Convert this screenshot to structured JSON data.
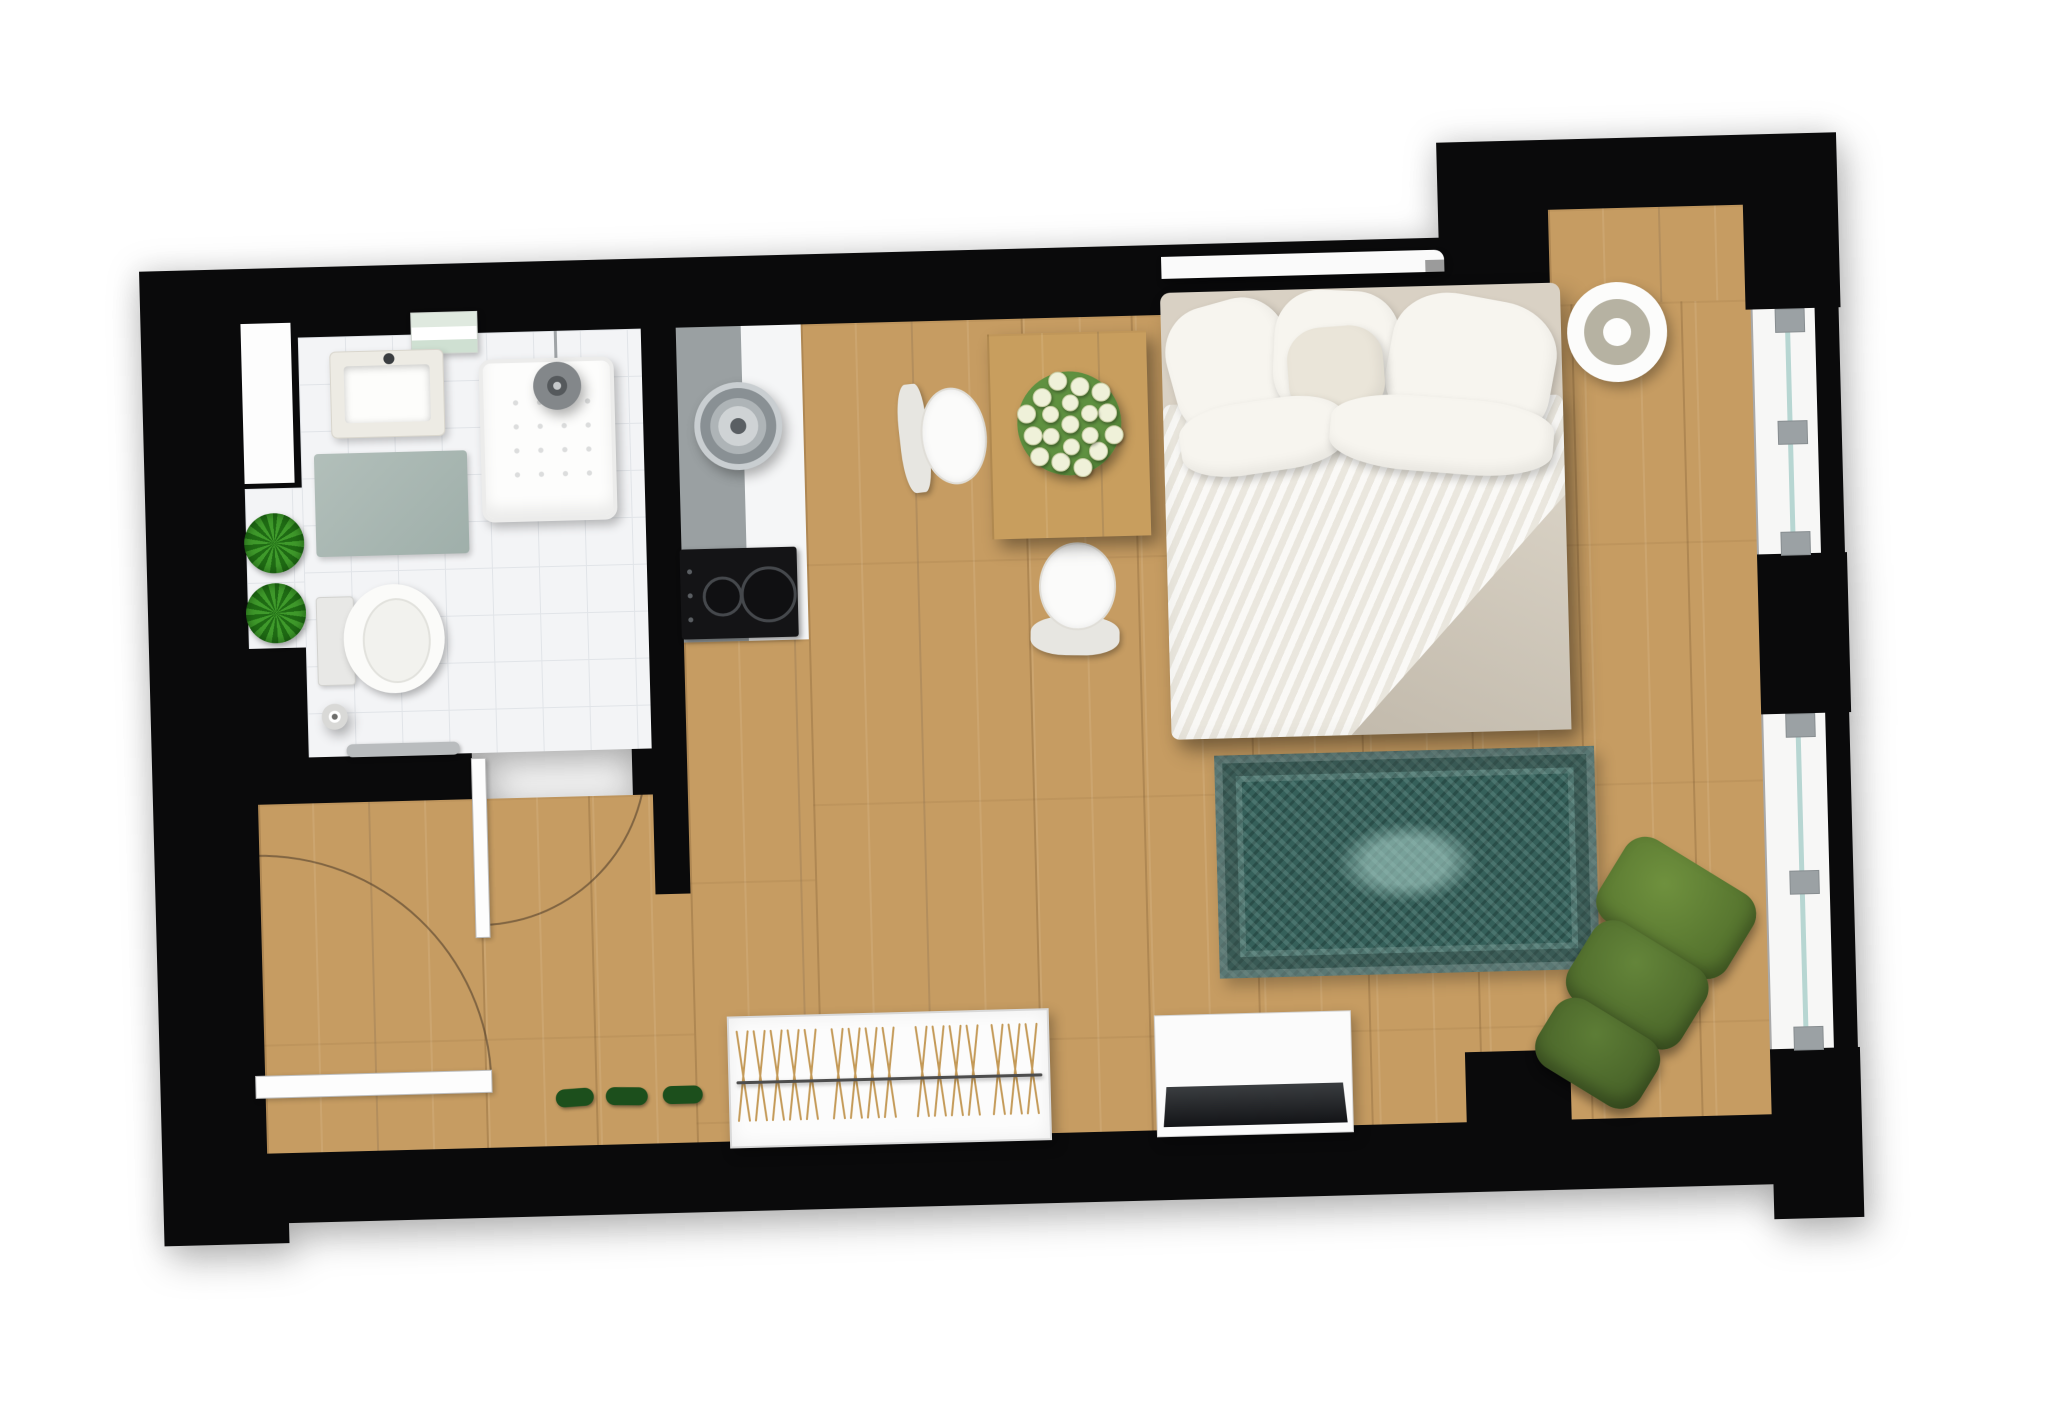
{
  "meta": {
    "description": "Top-down rendered floor plan of a studio apartment with bathroom, kitchenette, dining area, double bed, rug, armchair, wardrobe and TV console",
    "visible_text": []
  },
  "palette": {
    "wall": "#0a0a0b",
    "wood_floor": "#c69c62",
    "table_wood": "#c89e5e",
    "bathroom_tile": "#f3f4f6",
    "tile_grid": "#e1e4e8",
    "counter_gray": "#9aa0a2",
    "counter_white": "#f5f6f7",
    "rug_teal": "#35605a",
    "rug_light": "#a5cdc5",
    "bedding_white": "#f3f1eb",
    "bedding_beige": "#d9d1c4",
    "armchair_green": "#5d7d36",
    "plant_green": "#3f9a2b",
    "shoe_green": "#1c4f1c",
    "glass": "#b7d6d2",
    "door_swing": "rgba(74,58,40,0.55)"
  },
  "plan": {
    "origin_left": 150,
    "origin_top": 170,
    "width": 1710,
    "height": 1100,
    "rotation_deg": -1.5
  },
  "items": [
    {
      "n": "floor-main",
      "t": "wood",
      "x": 660,
      "y": 170,
      "w": 950,
      "h": 815
    },
    {
      "n": "floor-under-kitchen",
      "t": "wood",
      "x": 535,
      "y": 485,
      "w": 125,
      "h": 500
    },
    {
      "n": "floor-entry",
      "t": "wood",
      "x": 105,
      "y": 636,
      "w": 430,
      "h": 349
    },
    {
      "n": "alcove-floor",
      "t": "wood",
      "x": 1410,
      "y": 75,
      "w": 195,
      "h": 95
    },
    {
      "n": "bathroom-floor",
      "t": "tile",
      "x": 157,
      "y": 170,
      "w": 343,
      "h": 420
    },
    {
      "n": "kitchen-counter-gray",
      "t": "rect",
      "x": 535,
      "y": 170,
      "w": 65,
      "h": 315,
      "c": "#9aa0a2"
    },
    {
      "n": "kitchen-counter-white",
      "t": "rect",
      "x": 600,
      "y": 170,
      "w": 60,
      "h": 315,
      "c": "#f5f6f7"
    },
    {
      "n": "rug",
      "t": "rug",
      "x": 1062,
      "y": 612,
      "w": 380,
      "h": 223
    },
    {
      "n": "entry-door-swing",
      "t": "arc",
      "x": 100,
      "y": 686,
      "w": 232,
      "h": 232,
      "corner": "tr"
    },
    {
      "n": "bathroom-door-swing",
      "t": "arc",
      "x": 327,
      "y": 595,
      "w": 168,
      "h": 168,
      "corner": "br"
    },
    {
      "n": "wall-top",
      "t": "wall",
      "x": 0,
      "y": 100,
      "w": 1300,
      "h": 70
    },
    {
      "n": "wall-topright-pier",
      "t": "wall",
      "x": 1300,
      "y": 5,
      "w": 110,
      "h": 165
    },
    {
      "n": "wall-topright-top",
      "t": "wall",
      "x": 1410,
      "y": 5,
      "w": 290,
      "h": 70
    },
    {
      "n": "wall-topright-right",
      "t": "wall",
      "x": 1605,
      "y": 75,
      "w": 95,
      "h": 105
    },
    {
      "n": "wall-right-mid",
      "t": "wall",
      "x": 1610,
      "y": 425,
      "w": 90,
      "h": 160
    },
    {
      "n": "wall-right-lower",
      "t": "wall",
      "x": 1610,
      "y": 920,
      "w": 90,
      "h": 170
    },
    {
      "n": "wall-bottom",
      "t": "wall",
      "x": 0,
      "y": 985,
      "w": 1700,
      "h": 70
    },
    {
      "n": "wall-bottom-pier",
      "t": "wall",
      "x": 1305,
      "y": 915,
      "w": 105,
      "h": 70
    },
    {
      "n": "wall-bottomleft-step",
      "t": "wall",
      "x": 0,
      "y": 985,
      "w": 125,
      "h": 90
    },
    {
      "n": "wall-left-upper",
      "t": "wall",
      "x": 0,
      "y": 100,
      "w": 157,
      "h": 380
    },
    {
      "n": "wall-left-mid",
      "t": "wall",
      "x": 0,
      "y": 480,
      "w": 157,
      "h": 110
    },
    {
      "n": "wall-left-lower",
      "t": "wall",
      "x": 0,
      "y": 590,
      "w": 105,
      "h": 465
    },
    {
      "n": "wall-bath-kitchen",
      "t": "wall",
      "x": 500,
      "y": 100,
      "w": 35,
      "h": 636
    },
    {
      "n": "wall-bath-bottom-left",
      "t": "wall",
      "x": 105,
      "y": 590,
      "w": 215,
      "h": 46
    },
    {
      "n": "wall-bath-bottom-right",
      "t": "wall",
      "x": 480,
      "y": 590,
      "w": 20,
      "h": 46
    },
    {
      "n": "left-wall-window",
      "t": "rect",
      "x": 100,
      "y": 155,
      "w": 50,
      "h": 160,
      "c": "#fdfdfd",
      "cls": "nich"
    },
    {
      "n": "plant-shelf",
      "t": "tile",
      "x": 100,
      "y": 320,
      "w": 57,
      "h": 160,
      "cls": "nich"
    },
    {
      "n": "plant-top",
      "t": "plant",
      "x": 98,
      "y": 345,
      "w": 60,
      "h": 60
    },
    {
      "n": "plant-bottom",
      "t": "plant",
      "x": 98,
      "y": 415,
      "w": 60,
      "h": 60
    },
    {
      "n": "towel-shelf",
      "t": "towels",
      "x": 270,
      "y": 148,
      "w": 67,
      "h": 42
    },
    {
      "n": "bathroom-sink",
      "t": "sinkunit",
      "x": 188,
      "y": 185,
      "w": 114,
      "h": 87
    },
    {
      "n": "bath-mat",
      "t": "rect",
      "x": 170,
      "y": 287,
      "w": 153,
      "h": 103,
      "cls": "mat"
    },
    {
      "n": "shower-tray",
      "t": "shower",
      "x": 337,
      "y": 197,
      "w": 135,
      "h": 163
    },
    {
      "n": "shower-cord",
      "t": "rect",
      "x": 413,
      "y": 165,
      "w": 3,
      "h": 45,
      "c": "#9fa3a6"
    },
    {
      "n": "shower-head",
      "t": "rings",
      "x": 391,
      "y": 201,
      "w": 48,
      "h": 48,
      "rings": [
        [
          24,
          "#83878a"
        ],
        [
          10,
          "#55595c"
        ],
        [
          4,
          "#c6c9cb"
        ]
      ]
    },
    {
      "n": "toilet",
      "t": "toilet",
      "x": 168,
      "y": 419,
      "w": 128,
      "h": 109
    },
    {
      "n": "toilet-paper-holder",
      "t": "rings",
      "x": 171,
      "y": 537,
      "w": 26,
      "h": 26,
      "rings": [
        [
          13,
          "#d9d9d7"
        ],
        [
          6,
          "#ffffff"
        ],
        [
          3,
          "#6d6d6b"
        ]
      ]
    },
    {
      "n": "towel-rail",
      "t": "rect",
      "x": 195,
      "y": 578,
      "w": 113,
      "h": 13,
      "c": "#b9bcbe",
      "cls": "rail"
    },
    {
      "n": "entry-door-leaf",
      "t": "rect",
      "x": 95,
      "y": 907,
      "w": 237,
      "h": 23,
      "cls": "leaf"
    },
    {
      "n": "bathroom-door-leaf",
      "t": "rect",
      "x": 319,
      "y": 595,
      "w": 15,
      "h": 180,
      "cls": "leaf"
    },
    {
      "n": "kitchen-sink",
      "t": "rings",
      "x": 551,
      "y": 226,
      "w": 88,
      "h": 88,
      "rings": [
        [
          44,
          "#c9ced1"
        ],
        [
          38,
          "#899094"
        ],
        [
          28,
          "#aeb4b7"
        ],
        [
          20,
          "#cfd3d5"
        ],
        [
          8,
          "#5a5f63"
        ]
      ]
    },
    {
      "n": "cooktop",
      "t": "cooktop",
      "x": 533,
      "y": 392,
      "w": 117,
      "h": 90
    },
    {
      "n": "dining-table",
      "t": "wood",
      "x": 846,
      "y": 185,
      "w": 159,
      "h": 205,
      "cls": "table"
    },
    {
      "n": "flower-bouquet",
      "t": "flowers",
      "x": 861,
      "y": 211,
      "w": 130,
      "h": 130
    },
    {
      "n": "dining-chair-left",
      "t": "chair",
      "x": 756,
      "y": 223,
      "w": 86,
      "h": 123,
      "dir": "left",
      "rot": -5
    },
    {
      "n": "dining-chair-bottom",
      "t": "chair",
      "x": 877,
      "y": 390,
      "w": 101,
      "h": 123,
      "dir": "down",
      "rot": 2
    },
    {
      "n": "wall-shelf",
      "t": "rect",
      "x": 1022,
      "y": 112,
      "w": 283,
      "h": 22,
      "c": "#fafafa",
      "cls": "shelf"
    },
    {
      "n": "shelf-bracket",
      "t": "rect",
      "x": 1286,
      "y": 122,
      "w": 19,
      "h": 12,
      "c": "#9b9b9b",
      "cls": "bracket"
    },
    {
      "n": "bed",
      "t": "rect",
      "x": 1020,
      "y": 148,
      "w": 400,
      "h": 447,
      "c": "#d9d1c4",
      "cls": "bed"
    },
    {
      "n": "duvet",
      "t": "rect",
      "x": 1020,
      "y": 260,
      "w": 400,
      "h": 335,
      "cls": "duvet"
    },
    {
      "n": "duvet-fold",
      "t": "fold",
      "x": 1200,
      "y": 360,
      "w": 220,
      "h": 235
    },
    {
      "n": "pillow-left",
      "t": "pillow",
      "x": 1028,
      "y": 158,
      "w": 124,
      "h": 134,
      "rot": -14
    },
    {
      "n": "pillow-center",
      "t": "pillow",
      "x": 1132,
      "y": 150,
      "w": 126,
      "h": 128,
      "rot": 4
    },
    {
      "n": "pillow-right",
      "t": "pillow",
      "x": 1246,
      "y": 160,
      "w": 166,
      "h": 140,
      "rot": 12
    },
    {
      "n": "pillow-small",
      "t": "pillow",
      "x": 1146,
      "y": 186,
      "w": 96,
      "h": 90,
      "rot": -3,
      "c": "#eae5d9"
    },
    {
      "n": "pillow-lower-left",
      "t": "pillow",
      "x": 1036,
      "y": 258,
      "w": 166,
      "h": 72,
      "rot": -7
    },
    {
      "n": "pillow-lower-right",
      "t": "pillow",
      "x": 1186,
      "y": 260,
      "w": 224,
      "h": 75,
      "rot": 6
    },
    {
      "n": "decor-bowl",
      "t": "rings",
      "x": 1426,
      "y": 149,
      "w": 100,
      "h": 100,
      "rings": [
        [
          50,
          "#fcfcfb"
        ],
        [
          33,
          "#b6b2a2"
        ],
        [
          14,
          "#fdfdfc"
        ]
      ]
    },
    {
      "n": "armchair",
      "t": "armchair",
      "x": 1375,
      "y": 710,
      "w": 200,
      "h": 260,
      "rot": 33
    },
    {
      "n": "wardrobe",
      "t": "wardrobe",
      "x": 568,
      "y": 860,
      "w": 322,
      "h": 132,
      "count": 16
    },
    {
      "n": "tv-console",
      "t": "rect",
      "x": 995,
      "y": 870,
      "w": 197,
      "h": 122,
      "c": "#fbfbfb",
      "cls": "console"
    },
    {
      "n": "tv",
      "t": "tv",
      "x": 1002,
      "y": 942,
      "w": 184,
      "h": 40
    },
    {
      "n": "shoe-1",
      "t": "rect",
      "x": 395,
      "y": 928,
      "w": 38,
      "h": 18,
      "c": "#1c4f1c",
      "cls": "shoe",
      "rot": -3
    },
    {
      "n": "shoe-2",
      "t": "rect",
      "x": 445,
      "y": 928,
      "w": 42,
      "h": 18,
      "c": "#1c4f1c",
      "cls": "shoe",
      "rot": 2
    },
    {
      "n": "shoe-3",
      "t": "rect",
      "x": 502,
      "y": 928,
      "w": 40,
      "h": 18,
      "c": "#1c4f1c",
      "cls": "shoe"
    },
    {
      "n": "window-top",
      "t": "window",
      "x": 1612,
      "y": 180,
      "w": 86,
      "h": 245,
      "tabs": [
        0,
        112,
        223
      ]
    },
    {
      "n": "window-bottom",
      "t": "window",
      "x": 1612,
      "y": 585,
      "w": 86,
      "h": 335,
      "tabs": [
        0,
        157,
        313
      ]
    }
  ]
}
